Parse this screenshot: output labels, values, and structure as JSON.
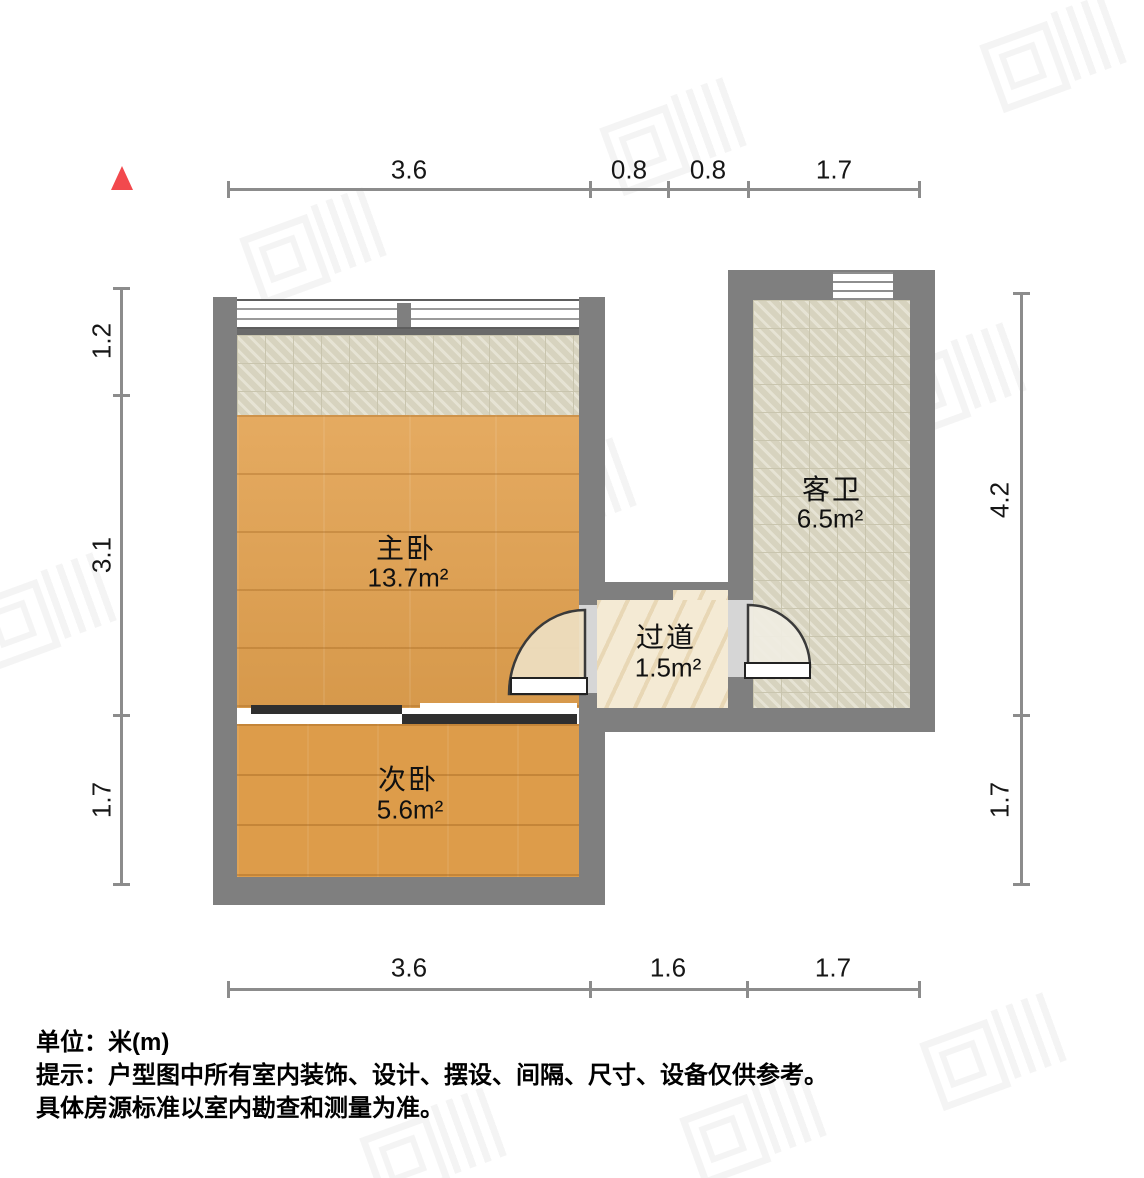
{
  "compass": {
    "symbol": "north"
  },
  "dimensions": {
    "top": [
      "3.6",
      "0.8",
      "0.8",
      "1.7"
    ],
    "bottom": [
      "3.6",
      "1.6",
      "1.7"
    ],
    "left": [
      "1.2",
      "3.1",
      "1.7"
    ],
    "right": [
      "4.2",
      "1.7"
    ]
  },
  "rooms": {
    "master": {
      "name": "主卧",
      "area": "13.7m²"
    },
    "second": {
      "name": "次卧",
      "area": "5.6m²"
    },
    "bath": {
      "name": "客卫",
      "area": "6.5m²"
    },
    "hallway": {
      "name": "过道",
      "area": "1.5m²"
    }
  },
  "notes": {
    "unit": "单位：米(m)",
    "tip1": "提示：户型图中所有室内装饰、设计、摆设、间隔、尺寸、设备仅供参考。",
    "tip2": "具体房源标准以室内勘查和测量为准。"
  },
  "colors": {
    "wall": "#7F7F7F",
    "opening": "#D6D6D6",
    "wood": "#E2A14F",
    "wood2": "#DD9C4A",
    "tile": "#DEDAC5",
    "tilegrid": "#C9C5AE",
    "hall": "#F0E3C6",
    "red": "#F2494D",
    "dim": "#8C8C8C",
    "panel": "#2F2F2F"
  }
}
